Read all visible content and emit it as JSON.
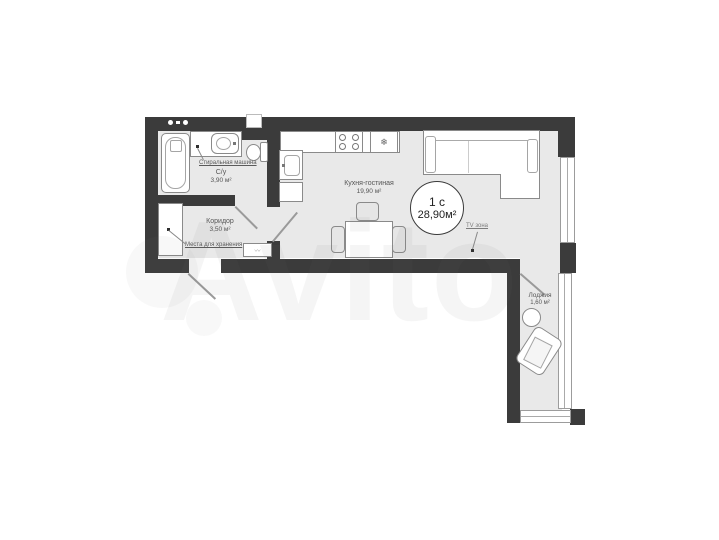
{
  "unit": {
    "type_label": "1 с",
    "total_area": "28,90м²"
  },
  "rooms": {
    "bathroom": {
      "name": "С/у",
      "area": "3,90 м²"
    },
    "corridor": {
      "name": "Коридор",
      "area": "3,50 м²"
    },
    "kitchen_living": {
      "name": "Кухня-гостиная",
      "area": "19,90 м²"
    },
    "loggia": {
      "name": "Лоджия",
      "area": "1,60 м²"
    }
  },
  "annotations": {
    "washing_machine": "Стиральная машина",
    "storage": "Места для хранения",
    "tv_zone": "TV зона"
  },
  "icons": {
    "fridge_snowflake": "❄",
    "bench_decor": "〰"
  },
  "watermark": {
    "text": "Avito"
  },
  "colors": {
    "wall": "#3b3b3b",
    "floor": "#e9e9e9",
    "outline": "#8a8a8a",
    "label": "#555555"
  }
}
